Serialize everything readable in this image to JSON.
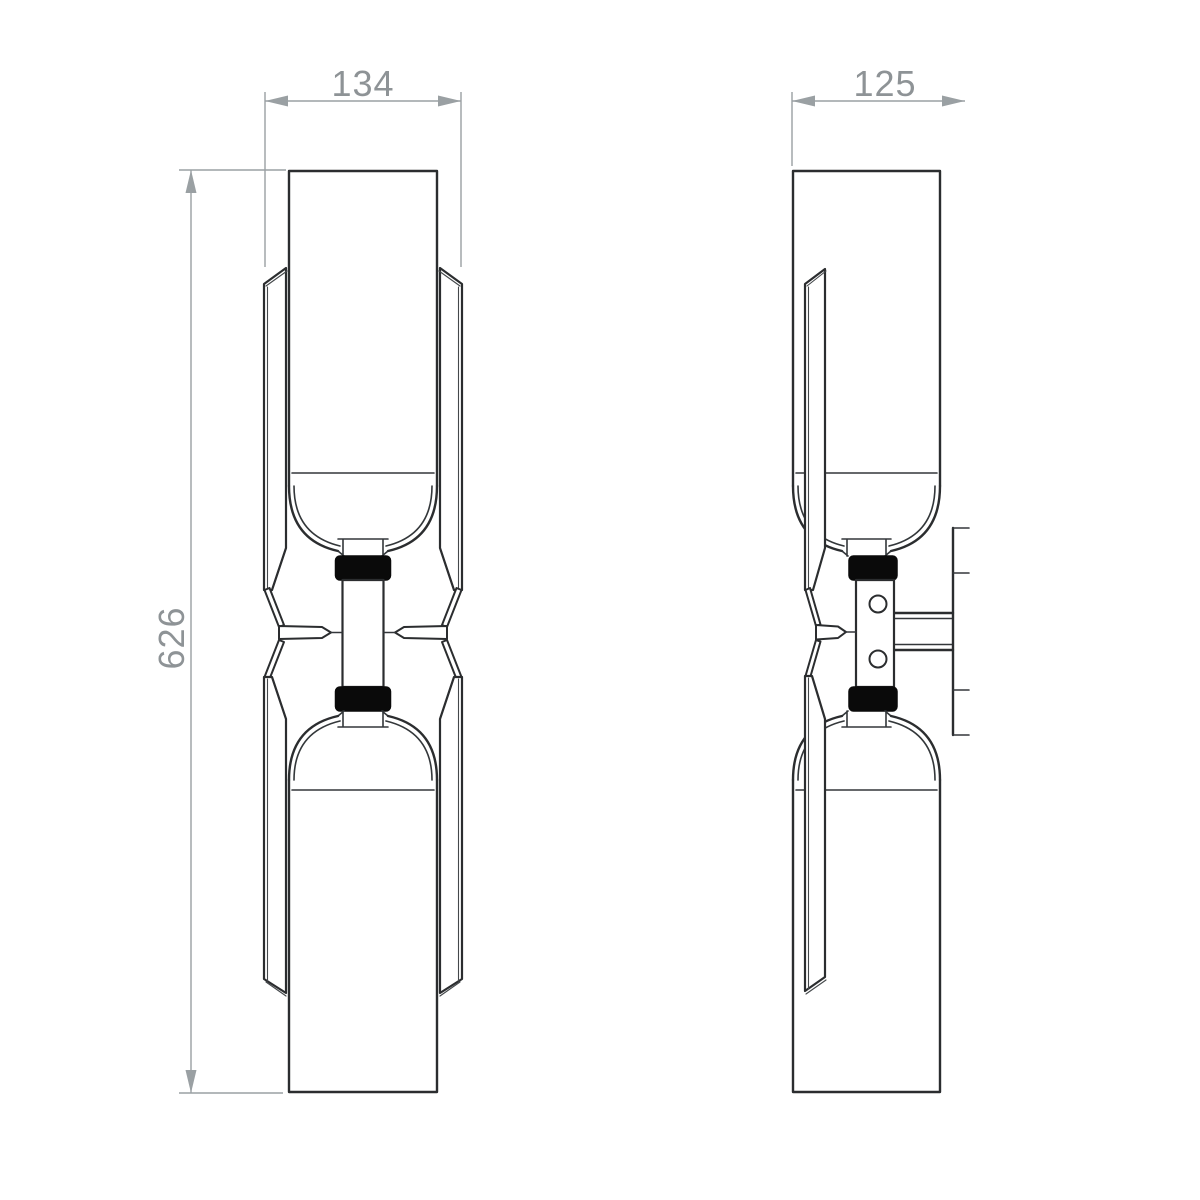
{
  "drawing": {
    "kind": "technical-dimension-drawing",
    "views": [
      "front-elevation",
      "side-elevation"
    ],
    "dimensions": {
      "front_width": {
        "label": "134",
        "value": 134
      },
      "front_height": {
        "label": "626",
        "value": 626
      },
      "side_depth": {
        "label": "125",
        "value": 125
      }
    },
    "colors": {
      "background": "#ffffff",
      "outline": "#2b2d2f",
      "ring_fill": "#0a0a0a",
      "dimension_gray": "#9aa0a3",
      "dimension_text_gray": "#8e9396"
    }
  }
}
